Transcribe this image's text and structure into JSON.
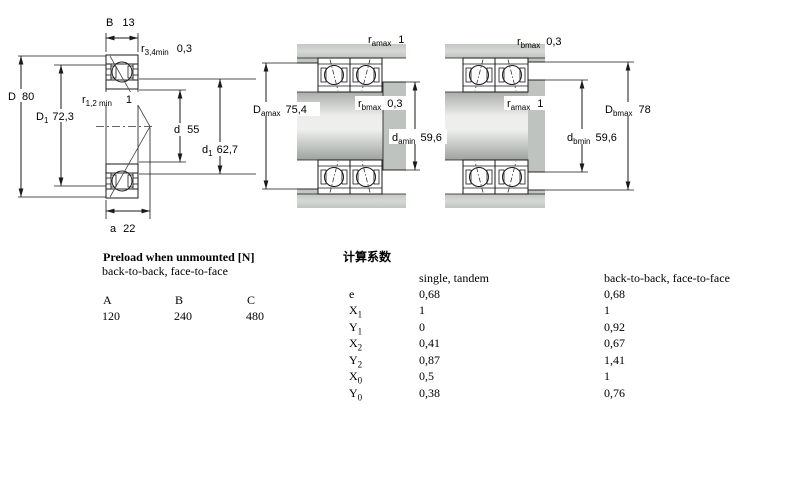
{
  "diagram": {
    "left": {
      "B": {
        "base": "B",
        "value": "13"
      },
      "r34": {
        "base": "r",
        "sub": "3,4min",
        "value": "0,3"
      },
      "D": {
        "base": "D",
        "value": "80"
      },
      "D1": {
        "base": "D",
        "sub": "1",
        "value": "72,3"
      },
      "r12": {
        "base": "r",
        "sub": "1,2 min",
        "value": "1"
      },
      "d": {
        "base": "d",
        "value": "55"
      },
      "d1": {
        "base": "d",
        "sub": "1",
        "value": "62,7"
      },
      "a": {
        "base": "a",
        "value": "22"
      }
    },
    "pair1": {
      "ramax": {
        "base": "r",
        "sub": "amax",
        "value": "1"
      },
      "rbmax": {
        "base": "r",
        "sub": "bmax",
        "value": "0,3"
      },
      "Damax": {
        "base": "D",
        "sub": "amax",
        "value": "75,4"
      },
      "damin": {
        "base": "d",
        "sub": "amin",
        "value": "59,6"
      }
    },
    "pair2": {
      "rbmax": {
        "base": "r",
        "sub": "bmax",
        "value": "0,3"
      },
      "ramax": {
        "base": "r",
        "sub": "amax",
        "value": "1"
      },
      "Dbmax": {
        "base": "D",
        "sub": "bmax",
        "value": "78"
      },
      "dbmin": {
        "base": "d",
        "sub": "bmin",
        "value": "59,6"
      }
    }
  },
  "preload": {
    "title": "Preload when unmounted [N]",
    "subtitle": "back-to-back, face-to-face",
    "columns": [
      "A",
      "B",
      "C"
    ],
    "values": [
      "120",
      "240",
      "480"
    ]
  },
  "factors": {
    "title": "计算系数",
    "col1_header": "single, tandem",
    "col2_header": "back-to-back, face-to-face",
    "rows": [
      {
        "base": "e",
        "sub": "",
        "single": "0,68",
        "btb": "0,68"
      },
      {
        "base": "X",
        "sub": "1",
        "single": "1",
        "btb": "1"
      },
      {
        "base": "Y",
        "sub": "1",
        "single": "0",
        "btb": "0,92"
      },
      {
        "base": "X",
        "sub": "2",
        "single": "0,41",
        "btb": "0,67"
      },
      {
        "base": "Y",
        "sub": "2",
        "single": "0,87",
        "btb": "1,41"
      },
      {
        "base": "X",
        "sub": "0",
        "single": "0,5",
        "btb": "1"
      },
      {
        "base": "Y",
        "sub": "0",
        "single": "0,38",
        "btb": "0,76"
      }
    ]
  },
  "colors": {
    "ring_hatch_blue": "#c5d2ea",
    "steel_gray": "#c6cac6",
    "line_black": "#1a1a1a"
  }
}
